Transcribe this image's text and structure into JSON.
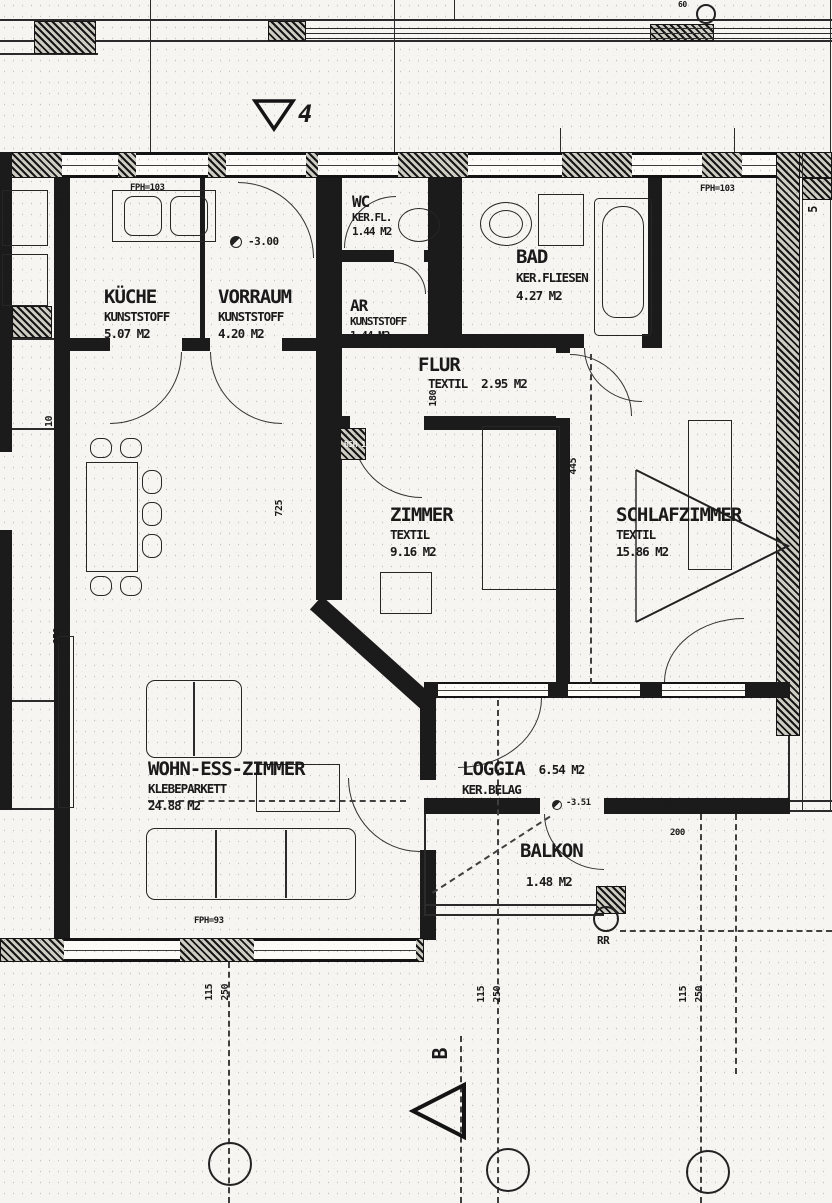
{
  "rooms": [
    {
      "name": "KÜCHE",
      "floor": "KUNSTSTOFF",
      "area": "5.07 M2"
    },
    {
      "name": "VORRAUM",
      "floor": "KUNSTSTOFF",
      "area": "4.20 M2"
    },
    {
      "name": "WC",
      "floor": "KER.FL.",
      "area": "1.44 M2"
    },
    {
      "name": "AR",
      "floor": "KUNSTSTOFF",
      "area": "1.44 M2"
    },
    {
      "name": "BAD",
      "floor": "KER.FLIESEN",
      "area": "4.27 M2"
    },
    {
      "name": "FLUR",
      "floor": "TEXTIL",
      "area": "2.95 M2"
    },
    {
      "name": "ZIMMER",
      "floor": "TEXTIL",
      "area": "9.16 M2"
    },
    {
      "name": "SCHLAFZIMMER",
      "floor": "TEXTIL",
      "area": "15.86 M2"
    },
    {
      "name": "WOHN-ESS-ZIMMER",
      "floor": "KLEBEPARKETT",
      "area": "24.88 M2"
    },
    {
      "name": "LOGGIA",
      "floor": "KER.BELAG",
      "area": "6.54 M2"
    },
    {
      "name": "BALKON",
      "floor": "",
      "area": "1.48 M2"
    }
  ],
  "markers": {
    "section_top": "4",
    "section_bottom": "B",
    "rainpipe": "RR",
    "grid_top": "60",
    "stair": "5"
  },
  "levels": {
    "vorraum": "-3.00",
    "balkon": "-3.51"
  },
  "annotations": {
    "fph_top_left": "FPH=103",
    "fph_top_right": "FPH=103",
    "fph_bottom": "FPH=93",
    "bsh": "BSH 18"
  },
  "dimensions": {
    "left_top": "100",
    "left_mid": "10",
    "left_bottom": "650",
    "vorraum_height": "725",
    "schlafzimmer": "445",
    "flur": "180",
    "loggia_w": "187",
    "loggia_h": "200",
    "grid_pairs": [
      {
        "a": "115",
        "b": "250"
      },
      {
        "a": "115",
        "b": "250"
      },
      {
        "a": "115",
        "b": "250"
      }
    ]
  },
  "colors": {
    "ink": "#1a1a1a",
    "paper": "#f6f5f1"
  }
}
